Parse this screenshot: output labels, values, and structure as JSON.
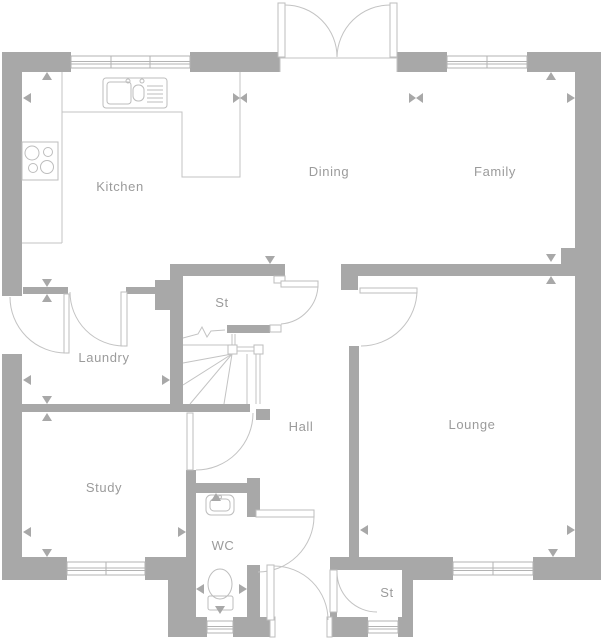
{
  "plan": {
    "title": "Ground floor plan",
    "rooms": [
      {
        "id": "kitchen",
        "label": "Kitchen"
      },
      {
        "id": "dining",
        "label": "Dining"
      },
      {
        "id": "family",
        "label": "Family"
      },
      {
        "id": "st-upper",
        "label": "St"
      },
      {
        "id": "laundry",
        "label": "Laundry"
      },
      {
        "id": "hall",
        "label": "Hall"
      },
      {
        "id": "lounge",
        "label": "Lounge"
      },
      {
        "id": "study",
        "label": "Study"
      },
      {
        "id": "wc",
        "label": "WC"
      },
      {
        "id": "st-lower",
        "label": "St"
      }
    ],
    "colors": {
      "wall": "#a8a8a8",
      "line": "#c3c3c3",
      "fixture": "#bdbdbd",
      "label": "#9b9b9b",
      "background": "#ffffff"
    }
  }
}
